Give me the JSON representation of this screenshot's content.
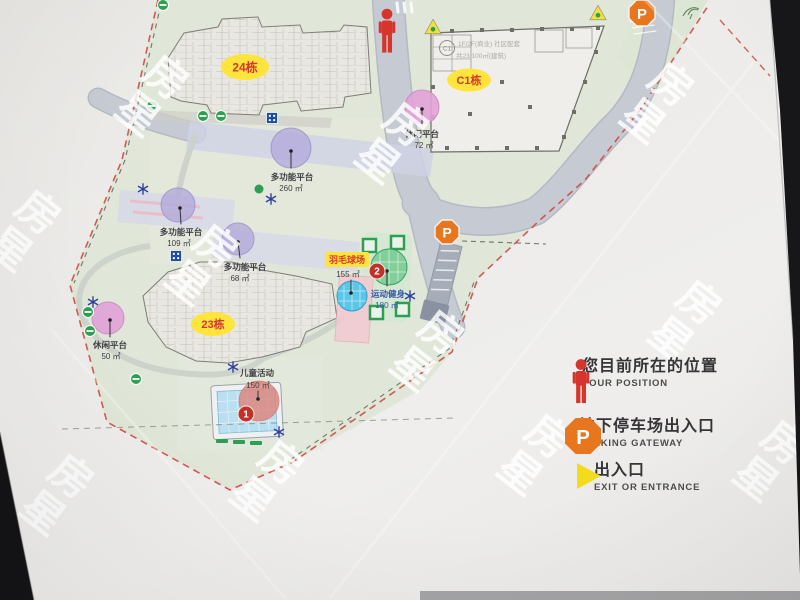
{
  "watermark": "房星",
  "colors": {
    "site_green": "#e0e7d8",
    "road_gray": "#c6cbd3",
    "tag_yellow": "#ffe43c",
    "tag_red_text": "#d5372e",
    "marker_red": "#c23128",
    "parking_orange": "#e8761e",
    "exit_yellow": "#f3dc1e",
    "platform_purple": "#b3abdc",
    "leisure_pink": "#e2a2d8",
    "court_blue": "#5cc6e8",
    "fitness_green": "#82cf9a",
    "position_red": "#d6352c"
  },
  "icons": {
    "parking_letter": "P"
  },
  "map": {
    "buildings": {
      "b24": {
        "tag": "24栋"
      },
      "b23": {
        "tag": "23栋"
      },
      "c1": {
        "tag": "C1栋",
        "badge": "C1",
        "info1": "1F/2F(商业) 社区配套",
        "info2": "共23,100㎡(建筑)"
      }
    },
    "areas": [
      {
        "label": "休闲平台",
        "size": "72 ㎡"
      },
      {
        "label": "多功能平台",
        "size": "260 ㎡"
      },
      {
        "label": "多功能平台",
        "size": "109 ㎡"
      },
      {
        "label": "多功能平台",
        "size": "68 ㎡"
      },
      {
        "label": "羽毛球场",
        "size": "155 ㎡"
      },
      {
        "label": "运动健身",
        "size": "180 ㎡"
      },
      {
        "label": "休闲平台",
        "size": "50 ㎡"
      },
      {
        "label": "儿童活动",
        "size": "150 ㎡"
      }
    ],
    "markers": {
      "pool": "1",
      "court": "2"
    }
  },
  "legend": {
    "items": [
      {
        "zh": "您目前所在的位置",
        "en": "YOUR POSITION"
      },
      {
        "zh": "地下停车场出入口",
        "en": "PARKING GATEWAY"
      },
      {
        "zh": "出入口",
        "en": "EXIT OR ENTRANCE"
      }
    ]
  }
}
